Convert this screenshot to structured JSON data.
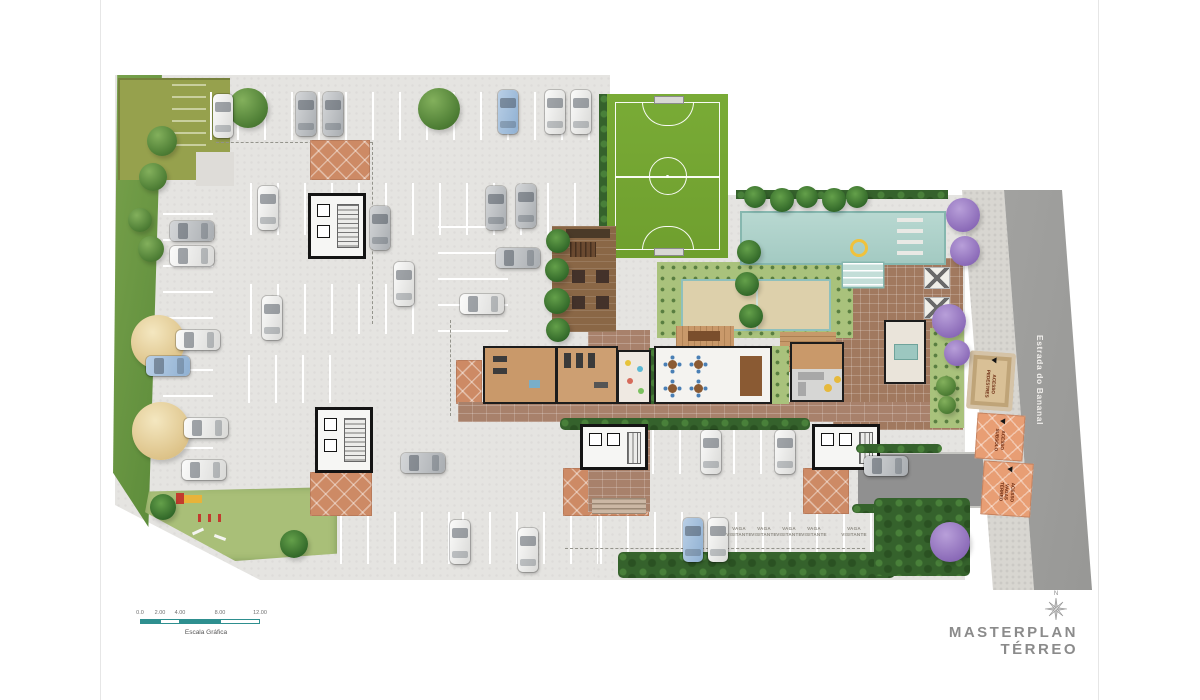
{
  "title": "MASTERPLAN TÉRREO",
  "compass": {
    "north": "N"
  },
  "scale_bar": {
    "label": "Escala Gráfica",
    "ticks": [
      "0.0",
      "2.00",
      "4.00",
      "8.00",
      "12.00"
    ]
  },
  "street": {
    "name": "Estrada do Bananal"
  },
  "access_labels": {
    "pedestrian": "ACESSO PEDESTRES",
    "basement": "ACESSO SUBSOLO",
    "ground_parking": "ACESSO VAGAS TÉRREO"
  },
  "parking": {
    "visitor_label": "VAGA VISITANTE"
  },
  "colors": {
    "concrete": "#e5e4e1",
    "field_green": "#74a733",
    "pool_teal": "#abd0c9",
    "terracotta": "#cd8a65",
    "deck_brown": "#8a6746",
    "sand": "#ddd0ab",
    "road_gray": "#9e9e9b",
    "sidewalk_gray": "#d8d6d1",
    "hedge_green": "#35622c",
    "lawn_green": "#a9c27c",
    "access_orange": "#e89e74",
    "access_tan": "#d9c096",
    "scale_teal": "#2e8f8f",
    "title_gray": "#8b8b8b"
  }
}
